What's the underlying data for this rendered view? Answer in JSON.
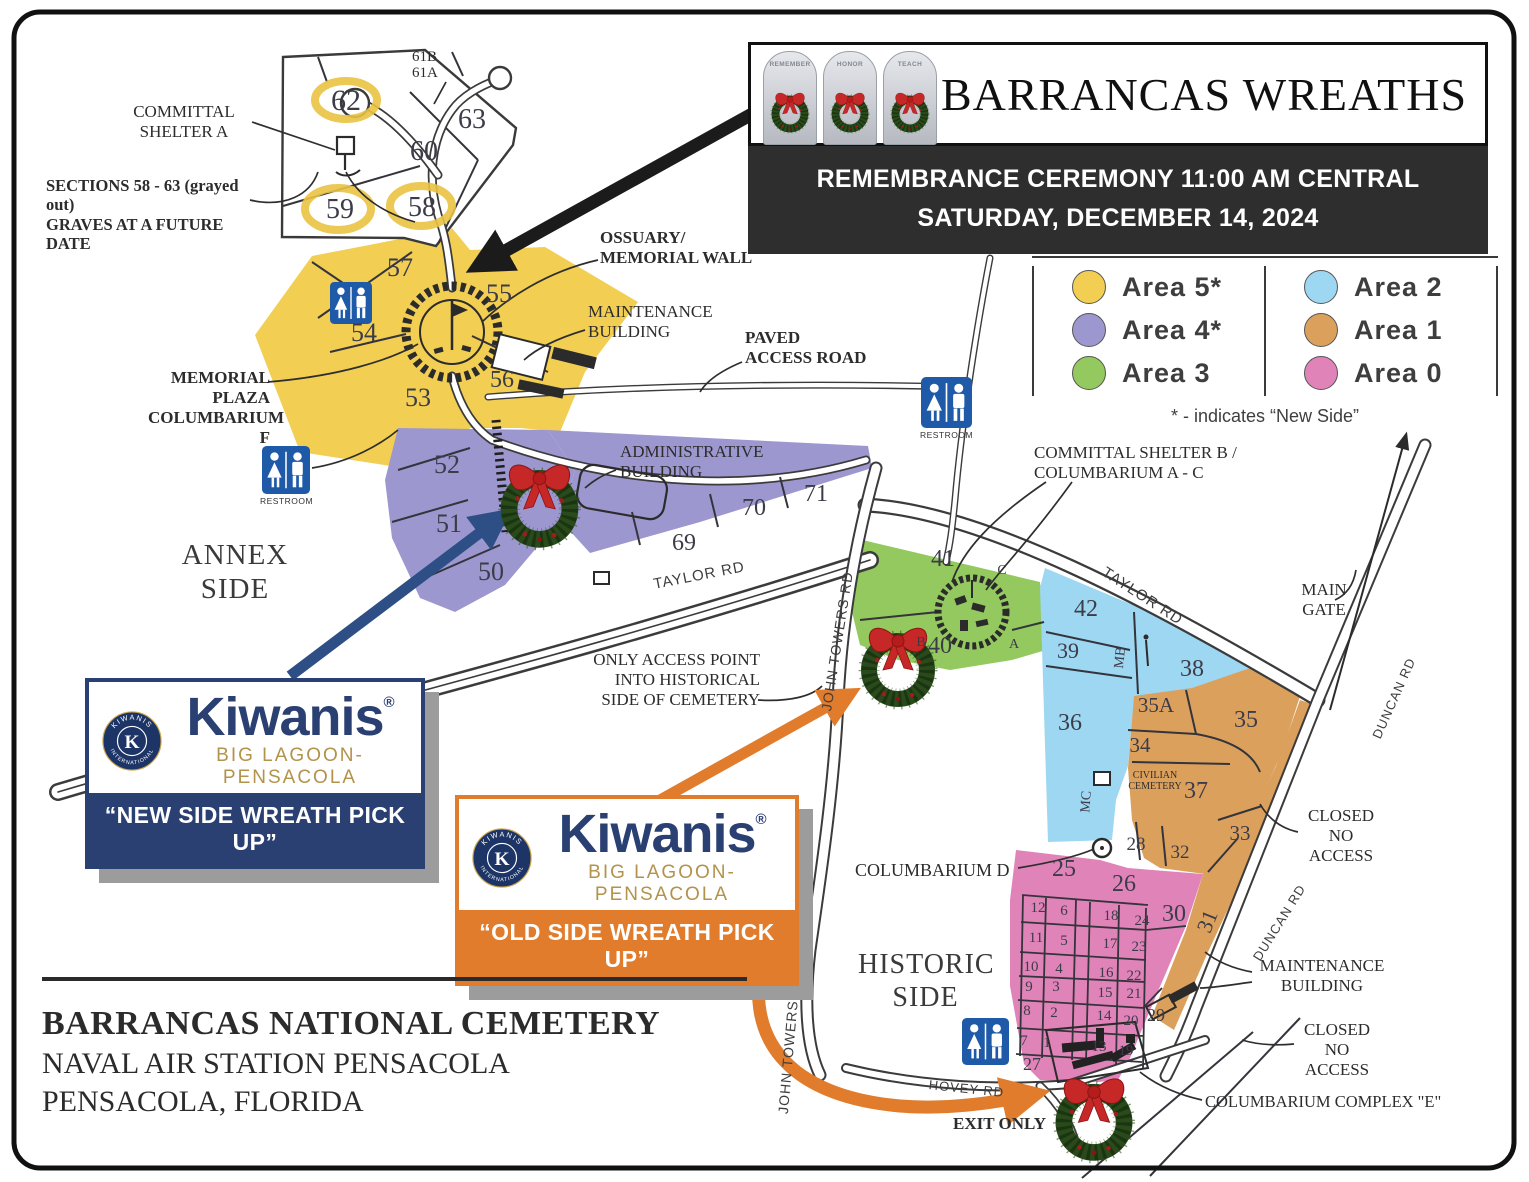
{
  "header": {
    "title": "BARRANCAS WREATHS",
    "banner_line1": "REMEMBRANCE CEREMONY 11:00 AM CENTRAL",
    "banner_line2": "SATURDAY, DECEMBER 14, 2024",
    "stones": {
      "s1": "REMEMBER",
      "s2": "HONOR",
      "s3": "TEACH"
    }
  },
  "legend": {
    "items": [
      {
        "label": "Area  5*",
        "color": "#F2CE52"
      },
      {
        "label": "Area  4*",
        "color": "#9D97CF"
      },
      {
        "label": "Area  3",
        "color": "#93C95E"
      },
      {
        "label": "Area  2",
        "color": "#9ED7F1"
      },
      {
        "label": "Area  1",
        "color": "#DCA05D"
      },
      {
        "label": "Area  0",
        "color": "#E083B8"
      }
    ],
    "footnote": "* - indicates “New Side”"
  },
  "kiwanis": {
    "brand": "Kiwanis",
    "reg": "®",
    "sub": "BIG LAGOON-PENSACOLA",
    "seal_top": "KIWANIS",
    "seal_bottom": "INTERNATIONAL",
    "seal_k": "K",
    "new_band": "“NEW SIDE WREATH PICK UP”",
    "old_band": "“OLD SIDE WREATH PICK UP”"
  },
  "footer": {
    "line1": "BARRANCAS NATIONAL CEMETERY",
    "line2": "NAVAL AIR STATION PENSACOLA",
    "line3": "PENSACOLA, FLORIDA"
  },
  "map": {
    "labels": {
      "committal_shelter_a": "COMMITTAL\nSHELTER A",
      "sections_note": "SECTIONS 58 - 63 (grayed out)\nGRAVES AT A FUTURE DATE",
      "ossuary": "OSSUARY/\nMEMORIAL WALL",
      "maintenance": "MAINTENANCE\nBUILDING",
      "paved_access": "PAVED\nACCESS ROAD",
      "memorial_plaza": "MEMORIAL PLAZA\nCOLUMBARIUM F",
      "admin": "ADMINISTRATIVE\nBUILDING",
      "annex_side": "ANNEX\nSIDE",
      "only_access": "ONLY ACCESS POINT\nINTO HISTORICAL\nSIDE OF CEMETERY",
      "committal_shelter_b": "COMMITTAL SHELTER B /\nCOLUMBARIUM A - C",
      "main_gate": "MAIN\nGATE",
      "closed": "CLOSED\nNO\nACCESS",
      "civilian_cemetery": "CIVILIAN\nCEMETERY",
      "columbarium_d": "COLUMBARIUM D",
      "historic_side": "HISTORIC\nSIDE",
      "columbarium_e": "COLUMBARIUM COMPLEX \"E\"",
      "exit_only": "EXIT ONLY",
      "hovey_rd": "HOVEY RD",
      "taylor_rd": "TAYLOR RD",
      "john_towers_rd": "JOHN TOWERS RD",
      "duncan_rd": "DUNCAN RD",
      "mb": "MB",
      "mc": "MC",
      "restroom": "RESTROOM",
      "s61": "61B\n61A",
      "ltr_a": "A",
      "ltr_b": "B",
      "ltr_c": "C"
    },
    "sections": {
      "s1": "1",
      "s2": "2",
      "s3": "3",
      "s4": "4",
      "s5": "5",
      "s6": "6",
      "s7": "7",
      "s8": "8",
      "s9": "9",
      "s10": "10",
      "s11": "11",
      "s12": "12",
      "s13": "13",
      "s14": "14",
      "s15": "15",
      "s16": "16",
      "s17": "17",
      "s18": "18",
      "s19": "19",
      "s20": "20",
      "s21": "21",
      "s22": "22",
      "s23": "23",
      "s24": "24",
      "s25": "25",
      "s26": "26",
      "s27": "27",
      "s28": "28",
      "s29": "29",
      "s30": "30",
      "s31": "31",
      "s32": "32",
      "s33": "33",
      "s34": "34",
      "s35": "35",
      "s35a": "35A",
      "s36": "36",
      "s37": "37",
      "s38": "38",
      "s39": "39",
      "s40": "40",
      "s41": "41",
      "s42": "42",
      "s50": "50",
      "s51": "51",
      "s52": "52",
      "s53": "53",
      "s54": "54",
      "s55": "55",
      "s56": "56",
      "s57": "57",
      "s58": "58",
      "s59": "59",
      "s60": "60",
      "s62": "62",
      "s63": "63",
      "s69": "69",
      "s70": "70",
      "s71": "71"
    }
  }
}
